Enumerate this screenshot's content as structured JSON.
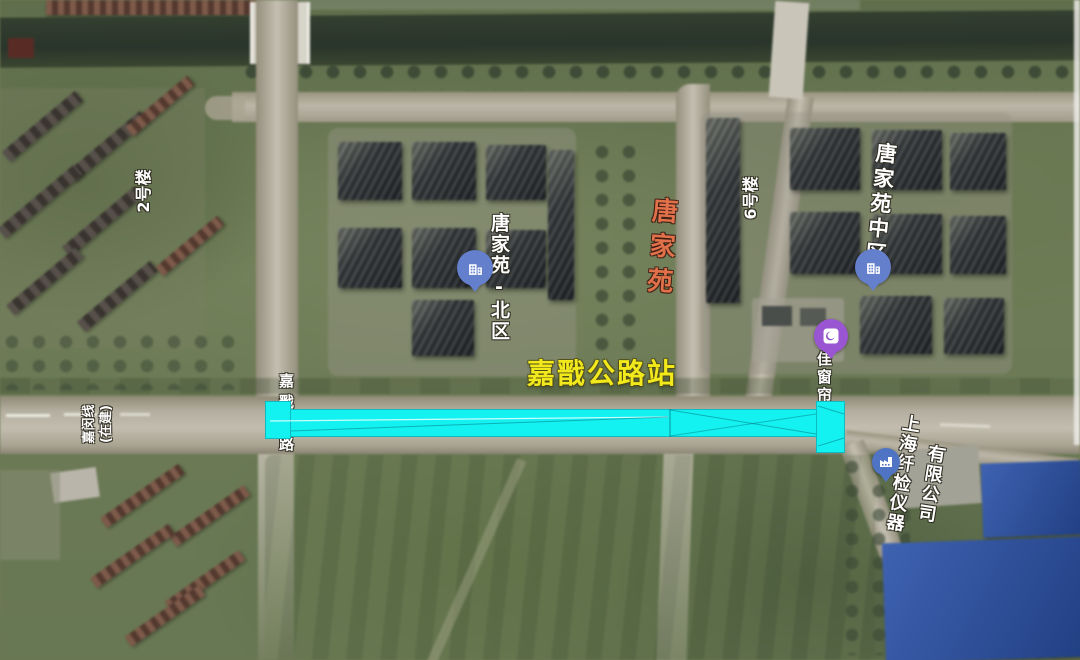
{
  "station": {
    "name": "嘉戬公路站"
  },
  "labels": {
    "building_2": "2号楼",
    "building_6": "6号楼",
    "tangjiayuan_north": "唐家苑-北区",
    "tangjiayuan": "唐家苑",
    "tangjiayuan_mid": "唐家苑中区",
    "jiamin_line": "嘉闵线",
    "jiamin_line_status": "(在建)",
    "jiajian_road": "嘉戬公路",
    "curtain_shop": "佳窗帘",
    "company_line1": "上海纤检仪器",
    "company_line2": "有限公司"
  },
  "pins": {
    "tangjiayuan_north_icon": "building-icon",
    "tangjiayuan_mid_icon": "building-icon",
    "curtain_shop_icon": "storefront-icon",
    "company_icon": "factory-icon"
  },
  "colors": {
    "overlay_cyan": "#14f1f1",
    "station_label_yellow": "#f2e91d",
    "tangjiayuan_orange": "#e0714a",
    "pin_blue": "#647fcb",
    "pin_purple": "#9a55d2",
    "pin_factory_blue": "#4f74c4",
    "label_white": "#ffffff"
  }
}
